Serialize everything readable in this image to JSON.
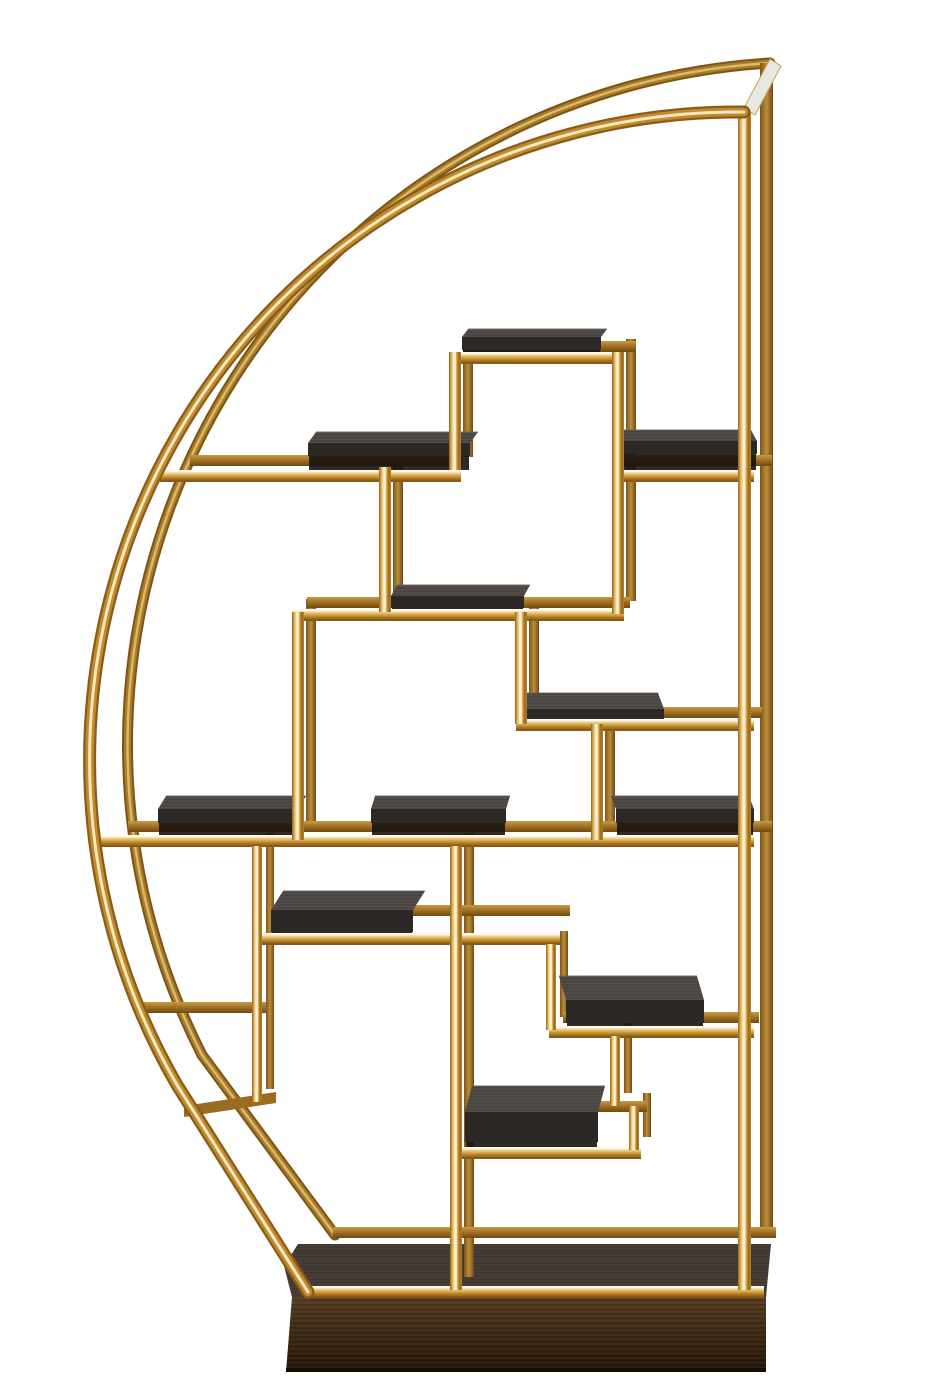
{
  "meta": {
    "domain": "natural-image",
    "subject": "Half-moon polished brass etagere display shelf with asymmetric geometric compartments, dark charcoal oak shelf panels and a dark walnut plinth base, photographed on a white background",
    "background": "#ffffff"
  },
  "palette": {
    "brass_dark": "#8a5c18",
    "brass_mid": "#c08a2e",
    "brass_core": "#f7e7bd",
    "brass_back_dark": "#7d5415",
    "brass_back_mid": "#a87b28",
    "brass_back_core": "#d9b96a",
    "rail_top_highlight": "#fff8e8",
    "rail_bottom_edge": "#6b4512",
    "panel_top": "#4c4744",
    "panel_top_edge": "#6a645c",
    "panel_front": "#2b2826",
    "panel_shadow": "#171310",
    "plinth_top": "#413931",
    "cap": "#e9e7e2",
    "cap_edge": "#c9a54b",
    "white": "#ffffff"
  },
  "geometry": {
    "canvas": {
      "w": 933,
      "h": 1400
    },
    "depth": {
      "dx": 14,
      "dy": -13
    },
    "hoops": {
      "front": {
        "path": "M744,112 A648,648 0 0 0 177,1085 L308,1292"
      },
      "back": {
        "path": "M770,63 A683,683 0 0 0 202,1055 L335,1235"
      }
    },
    "cap": [
      [
        744,
        108
      ],
      [
        770,
        59
      ],
      [
        781,
        66
      ],
      [
        755,
        115
      ]
    ],
    "posts": {
      "front": {
        "x": 738,
        "y1": 112,
        "y2": 1290,
        "w": 13
      },
      "back": {
        "x": 760,
        "y1": 63,
        "y2": 1234,
        "w": 13
      }
    },
    "rails_back": [
      {
        "x1": 190,
        "x2": 462,
        "y": 455
      },
      {
        "x1": 616,
        "x2": 772,
        "y": 455
      },
      {
        "x1": 464,
        "x2": 636,
        "y": 341
      },
      {
        "x1": 307,
        "x2": 630,
        "y": 597
      },
      {
        "x1": 529,
        "x2": 762,
        "y": 707
      },
      {
        "x1": 128,
        "x2": 772,
        "y": 821
      },
      {
        "x1": 278,
        "x2": 570,
        "y": 905
      },
      {
        "x1": 137,
        "x2": 266,
        "y": 1002
      },
      {
        "x1": 563,
        "x2": 759,
        "y": 1012
      },
      {
        "x1": 597,
        "x2": 647,
        "y": 1101
      },
      {
        "x1": 333,
        "x2": 776,
        "y": 1227
      }
    ],
    "rail_slanted": [
      [
        184,
        1106
      ],
      [
        276,
        1092
      ],
      [
        276,
        1103
      ],
      [
        184,
        1117
      ]
    ],
    "rails_front": [
      {
        "x1": 160,
        "x2": 461,
        "y": 470
      },
      {
        "x1": 612,
        "x2": 754,
        "y": 470
      },
      {
        "x1": 449,
        "x2": 624,
        "y": 352
      },
      {
        "x1": 293,
        "x2": 624,
        "y": 609
      },
      {
        "x1": 516,
        "x2": 754,
        "y": 719
      },
      {
        "x1": 96,
        "x2": 754,
        "y": 835
      },
      {
        "x1": 252,
        "x2": 560,
        "y": 933
      },
      {
        "x1": 549,
        "x2": 754,
        "y": 1026
      },
      {
        "x1": 451,
        "x2": 641,
        "y": 1147
      },
      {
        "x1": 306,
        "x2": 764,
        "y": 1286
      }
    ],
    "verticals": [
      {
        "x": 449,
        "y1": 352,
        "y2": 470,
        "w": 12
      },
      {
        "x": 612,
        "y1": 352,
        "y2": 614,
        "w": 12
      },
      {
        "x": 379,
        "y1": 467,
        "y2": 612,
        "w": 12
      },
      {
        "x": 292,
        "y1": 612,
        "y2": 840,
        "w": 12
      },
      {
        "x": 515,
        "y1": 612,
        "y2": 724,
        "w": 12
      },
      {
        "x": 591,
        "y1": 724,
        "y2": 840,
        "w": 12
      },
      {
        "x": 252,
        "y1": 846,
        "y2": 1102,
        "w": 10
      },
      {
        "x": 546,
        "y1": 944,
        "y2": 1030,
        "w": 10
      },
      {
        "x": 610,
        "y1": 1036,
        "y2": 1106,
        "w": 10
      },
      {
        "x": 629,
        "y1": 1106,
        "y2": 1150,
        "w": 10
      },
      {
        "x": 450,
        "y1": 846,
        "y2": 1290,
        "w": 12
      }
    ],
    "shelves": [
      {
        "x1": 462,
        "x2": 601,
        "y": 337,
        "fh": 13,
        "th": 8,
        "skew": 6,
        "shadow": 2
      },
      {
        "x1": 308,
        "x2": 470,
        "y": 443,
        "fh": 13,
        "th": 11,
        "skew": 8,
        "shadow": 14
      },
      {
        "x1": 623,
        "x2": 757,
        "y": 441,
        "fh": 13,
        "th": 11,
        "skew": -6,
        "shadow": 16
      },
      {
        "x1": 391,
        "x2": 524,
        "y": 596,
        "fh": 12,
        "th": 11,
        "skew": 6,
        "shadow": 1
      },
      {
        "x1": 526,
        "x2": 664,
        "y": 709,
        "fh": 11,
        "th": 16,
        "skew": -6,
        "shadow": 0
      },
      {
        "x1": 158,
        "x2": 298,
        "y": 809,
        "fh": 14,
        "th": 13,
        "skew": 8,
        "shadow": 12
      },
      {
        "x1": 371,
        "x2": 506,
        "y": 809,
        "fh": 14,
        "th": 13,
        "skew": 4,
        "shadow": 12
      },
      {
        "x1": 616,
        "x2": 754,
        "y": 809,
        "fh": 14,
        "th": 13,
        "skew": -5,
        "shadow": 12
      },
      {
        "x1": 271,
        "x2": 413,
        "y": 910,
        "fh": 22,
        "th": 19,
        "skew": 12,
        "shadow": 1
      },
      {
        "x1": 566,
        "x2": 704,
        "y": 1000,
        "fh": 23,
        "th": 24,
        "skew": -7,
        "shadow": 3
      },
      {
        "x1": 465,
        "x2": 598,
        "y": 1112,
        "fh": 30,
        "th": 26,
        "skew": 7,
        "shadow": 5
      }
    ],
    "plinth": {
      "top": [
        [
          292,
          1297
        ],
        [
          766,
          1297
        ],
        [
          771,
          1244
        ],
        [
          298,
          1244
        ],
        [
          284,
          1266
        ]
      ],
      "front": [
        [
          292,
          1297
        ],
        [
          766,
          1297
        ],
        [
          766,
          1372
        ],
        [
          286,
          1372
        ]
      ]
    }
  }
}
